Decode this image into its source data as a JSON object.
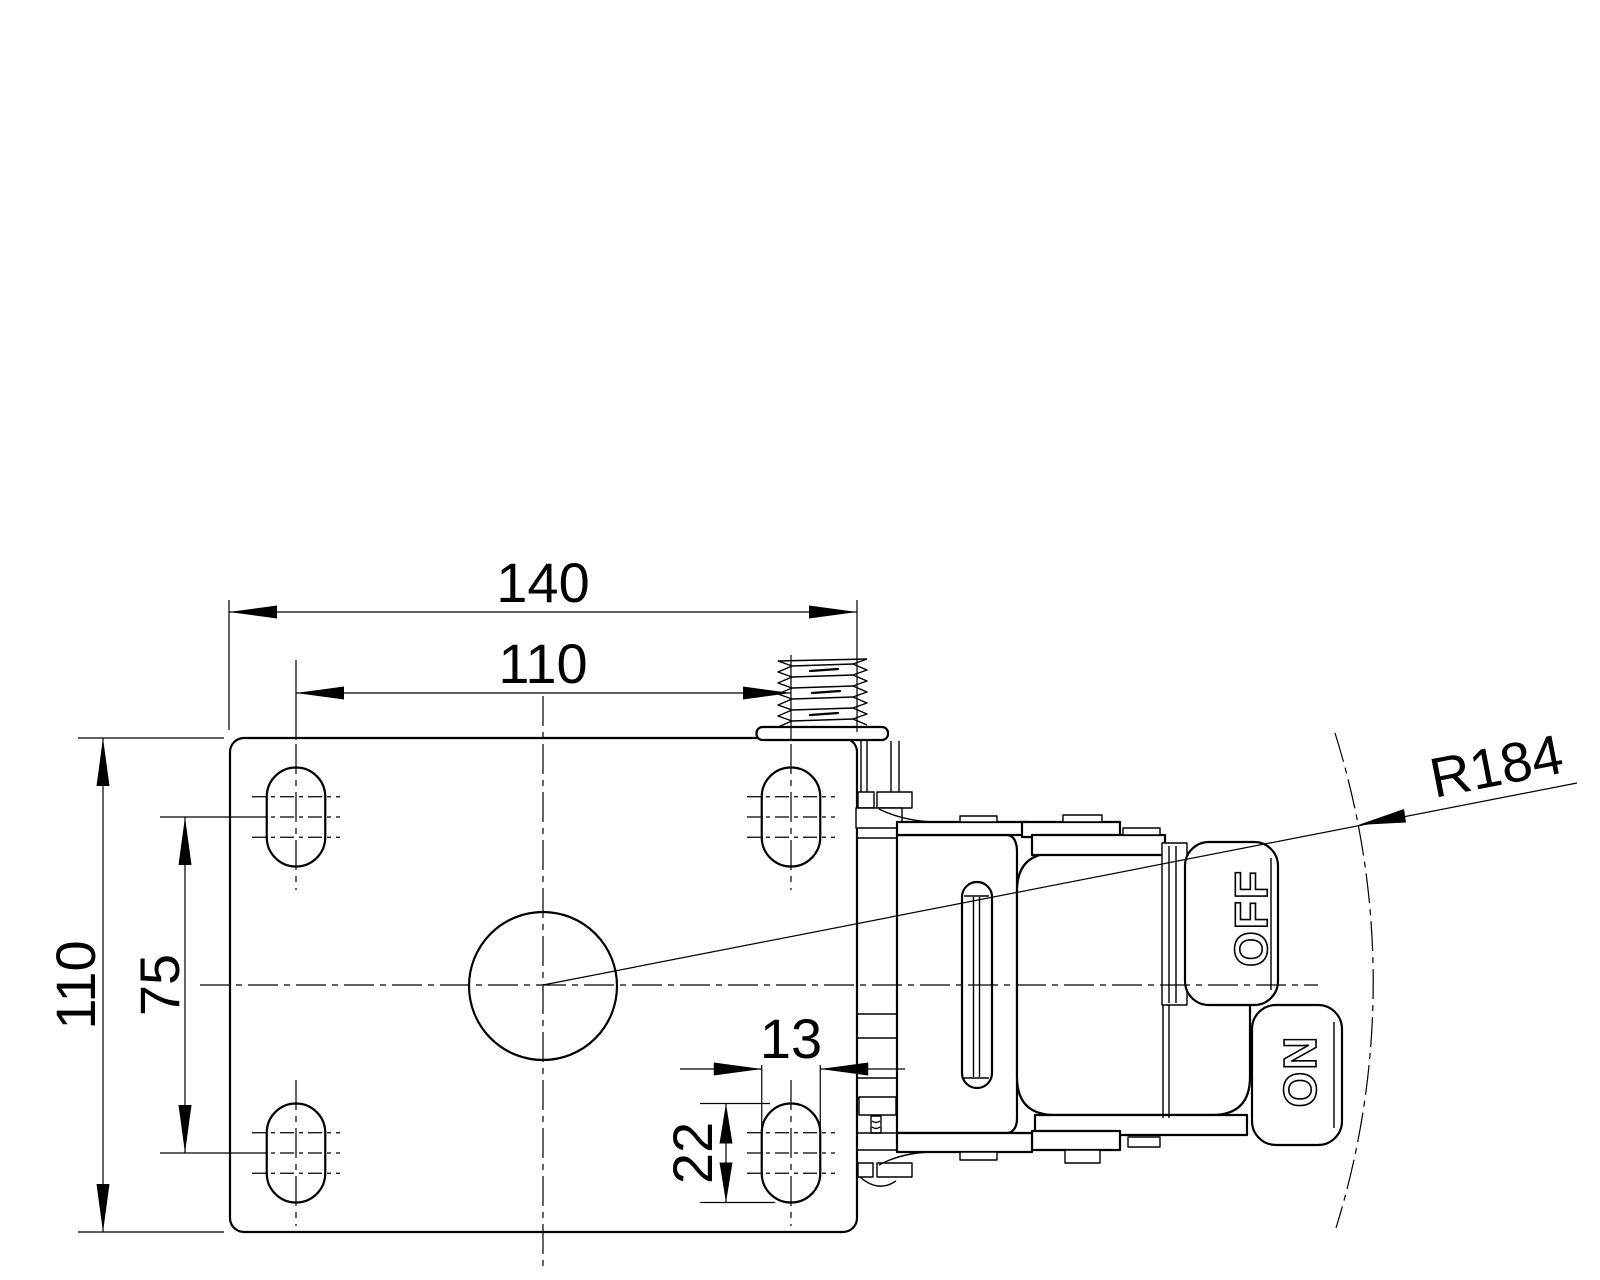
{
  "drawing": {
    "type": "caster-mounting-plate-technical-drawing",
    "background_color": "#ffffff",
    "line_color": "#000000",
    "dimensions": {
      "plate_width": "140",
      "hole_spacing_horizontal": "110",
      "plate_depth": "110",
      "hole_spacing_vertical": "75",
      "slot_width": "13",
      "slot_length": "22",
      "swivel_radius": "R184"
    },
    "pedal_labels": {
      "off": "OFF",
      "on": "ON"
    }
  }
}
